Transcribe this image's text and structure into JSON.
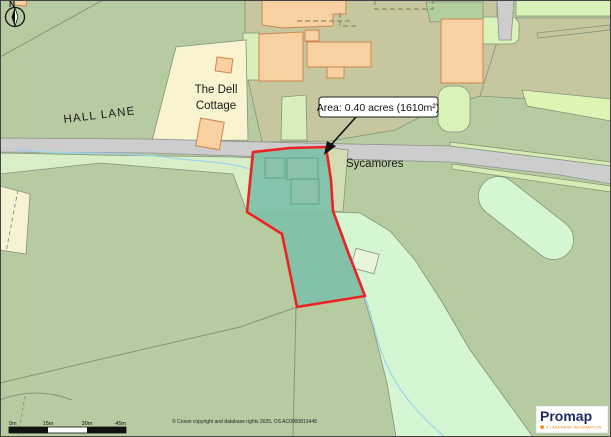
{
  "map": {
    "compass": {
      "label": "N"
    },
    "labels": {
      "hall_lane": "HALL LANE",
      "dell_cottage_line1": "The Dell",
      "dell_cottage_line2": "Cottage",
      "sycamores": "Sycamores"
    },
    "area_annotation": {
      "text": "Area: 0.40 acres (1610m²)"
    },
    "scale_bar": {
      "ticks": [
        "0m",
        "15m",
        "30m",
        "45m"
      ]
    },
    "copyright": "© Crown copyright and database rights 2025. OS AC0000813448",
    "logo": {
      "brand": "Promap",
      "tagline": "A LANDMARK INFORMATION"
    },
    "colors": {
      "field_green": "#b7cba0",
      "pale_verge_green": "#d8eec6",
      "mint_green": "#d5f6d2",
      "khaki": "#c6c79e",
      "cream": "#f9f3d0",
      "building_orange": "#f8d0a2",
      "building_outline": "#c98850",
      "road_gray": "#cdcdcd",
      "selection_teal": "#7ec0a9",
      "boundary_red": "#ee2222",
      "stream_blue": "#9dd6ee",
      "logo_navy": "#1c2b5e",
      "logo_orange": "#f07d00"
    }
  }
}
